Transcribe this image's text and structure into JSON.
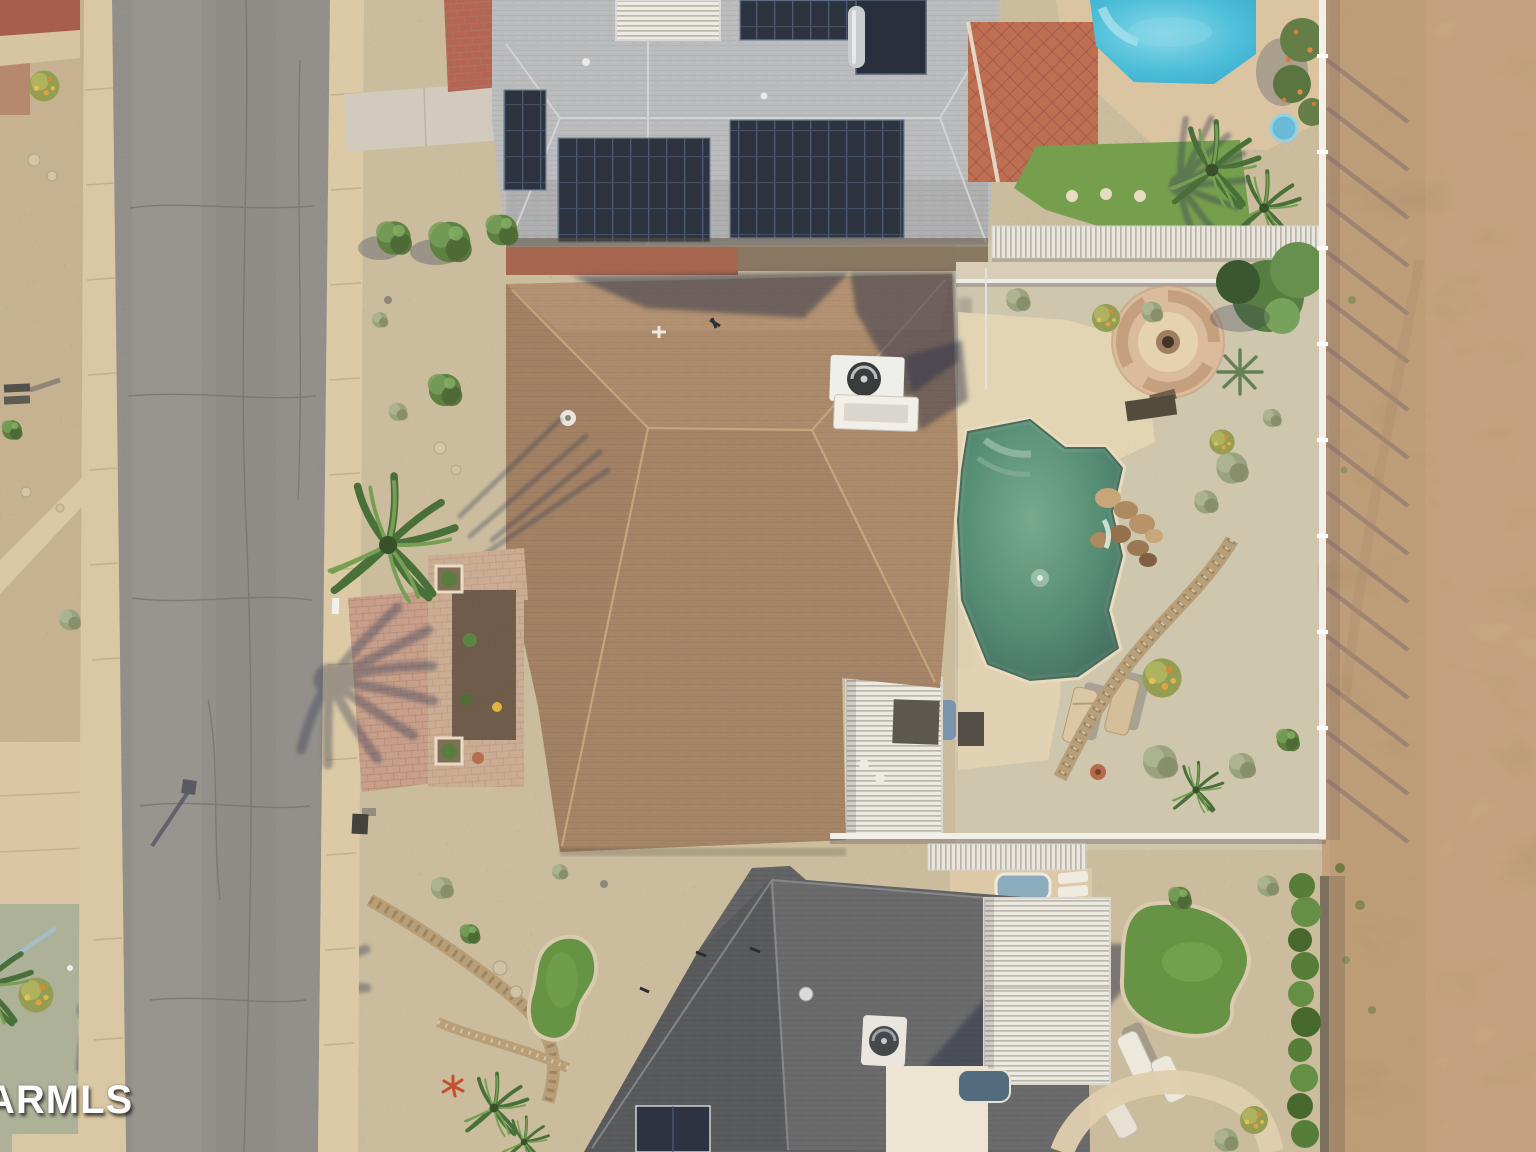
{
  "watermark": {
    "text": "ARMLS"
  },
  "palette": {
    "asphalt": "#8e8c8a",
    "sidewalk": "#d9c7a5",
    "gravelWarm": "#c8bb9e",
    "gravelCool": "#cdc6b0",
    "gravelSage": "#a9af98",
    "dirt": "#c1a07e",
    "roofBrown": "#a8876a",
    "roofGray": "#b7babe",
    "roofDark": "#5a5d61",
    "poolCyan": "#45bedd",
    "poolGreen": "#4f8b74",
    "turf": "#5e9040",
    "lawn": "#6e9b4a",
    "paverRed": "#b06050",
    "paverPink": "#c49c8a",
    "concrete": "#e2d4b5",
    "fenceWhite": "#f4f3f1",
    "hedgeGreen": "#4d7a33",
    "solarPanel": "#232c3a",
    "terracotta": "#a2604c"
  }
}
